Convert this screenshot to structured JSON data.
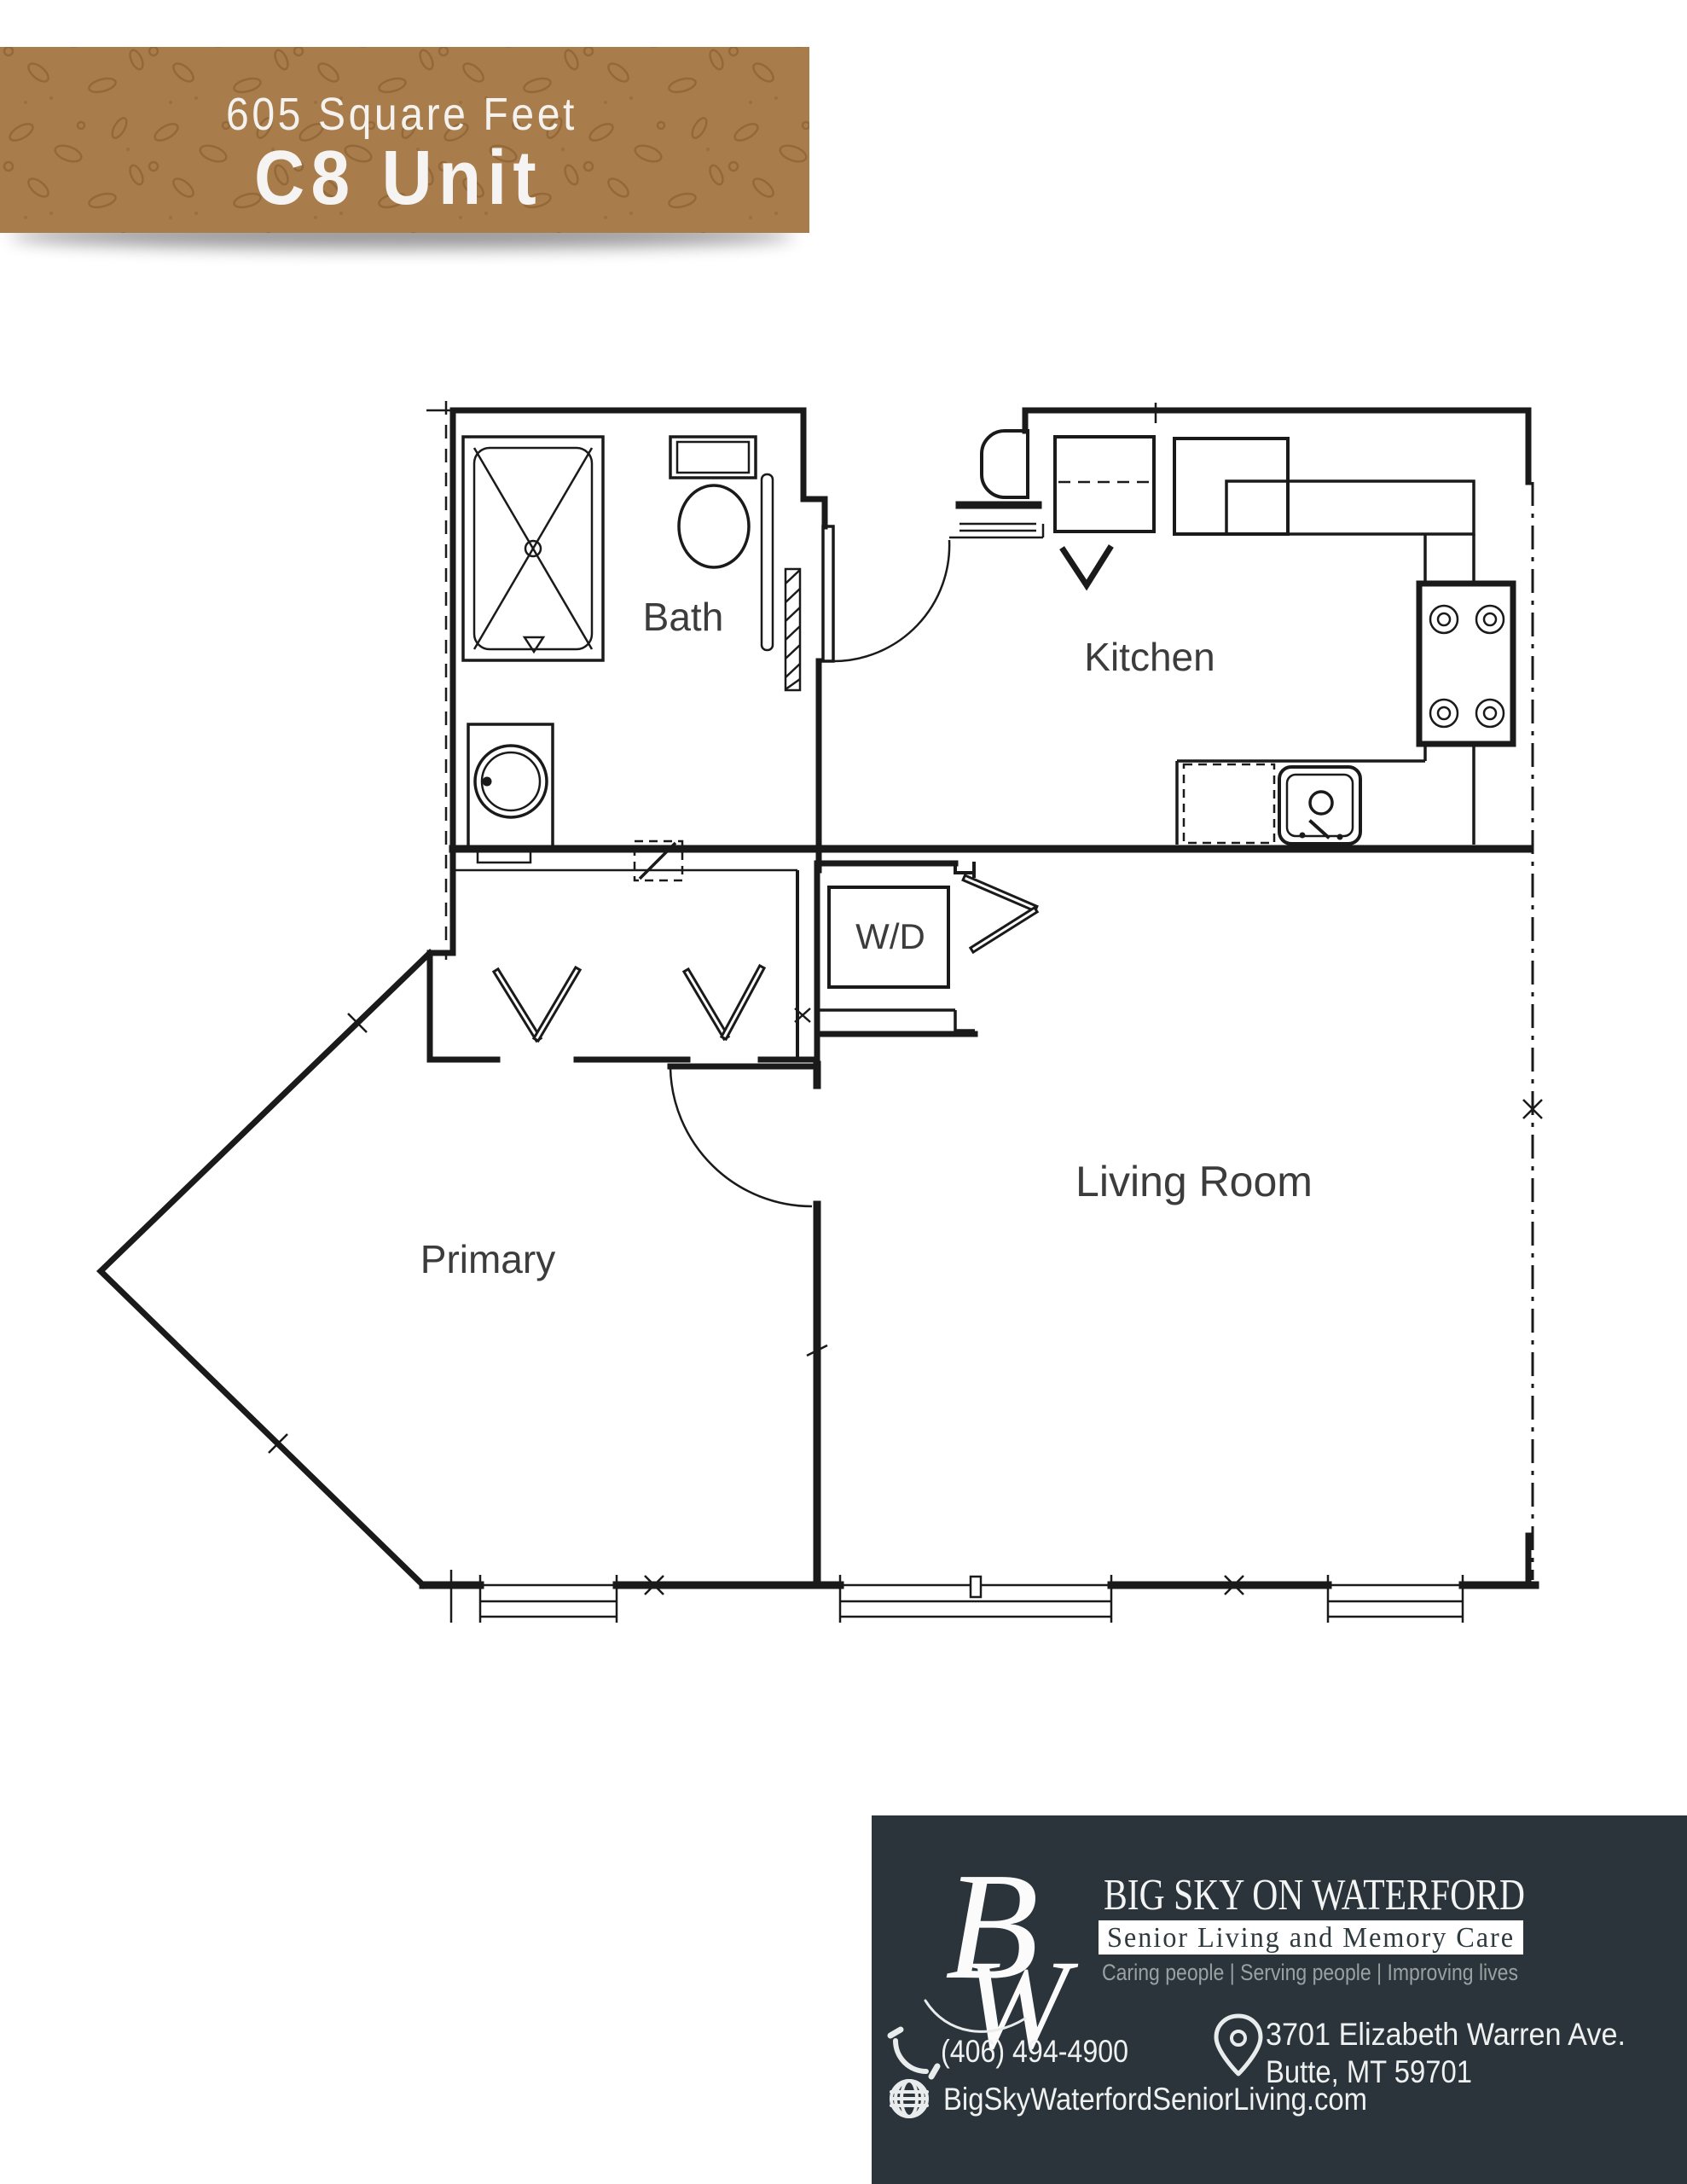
{
  "banner": {
    "subtitle": "605 Square Feet",
    "title": "C8 Unit",
    "background": "#a87c4b",
    "pattern_color": "#8d6233",
    "text_color": "#f4f2ee"
  },
  "plan": {
    "line_color": "#1a1a1a",
    "label_color": "#3c3c3c",
    "labels": {
      "bath": "Bath",
      "kitchen": "Kitchen",
      "laundry": "W/D",
      "primary": "Primary",
      "living": "Living Room"
    }
  },
  "footer": {
    "background": "#2a343a",
    "monogram_b": "B",
    "monogram_w": "W",
    "name": "BIG SKY ON WATERFORD",
    "subtitle": "Senior Living and Memory Care",
    "tagline": "Caring people | Serving people | Improving lives",
    "phone": "(406) 494-4900",
    "address_line1": "3701 Elizabeth Warren Ave.",
    "address_line2": "Butte, MT 59701",
    "website": "BigSkyWaterfordSeniorLiving.com",
    "subtitle_box": "#ffffff",
    "tagline_color": "#99a1a4",
    "text_color": "#eff1f1"
  }
}
